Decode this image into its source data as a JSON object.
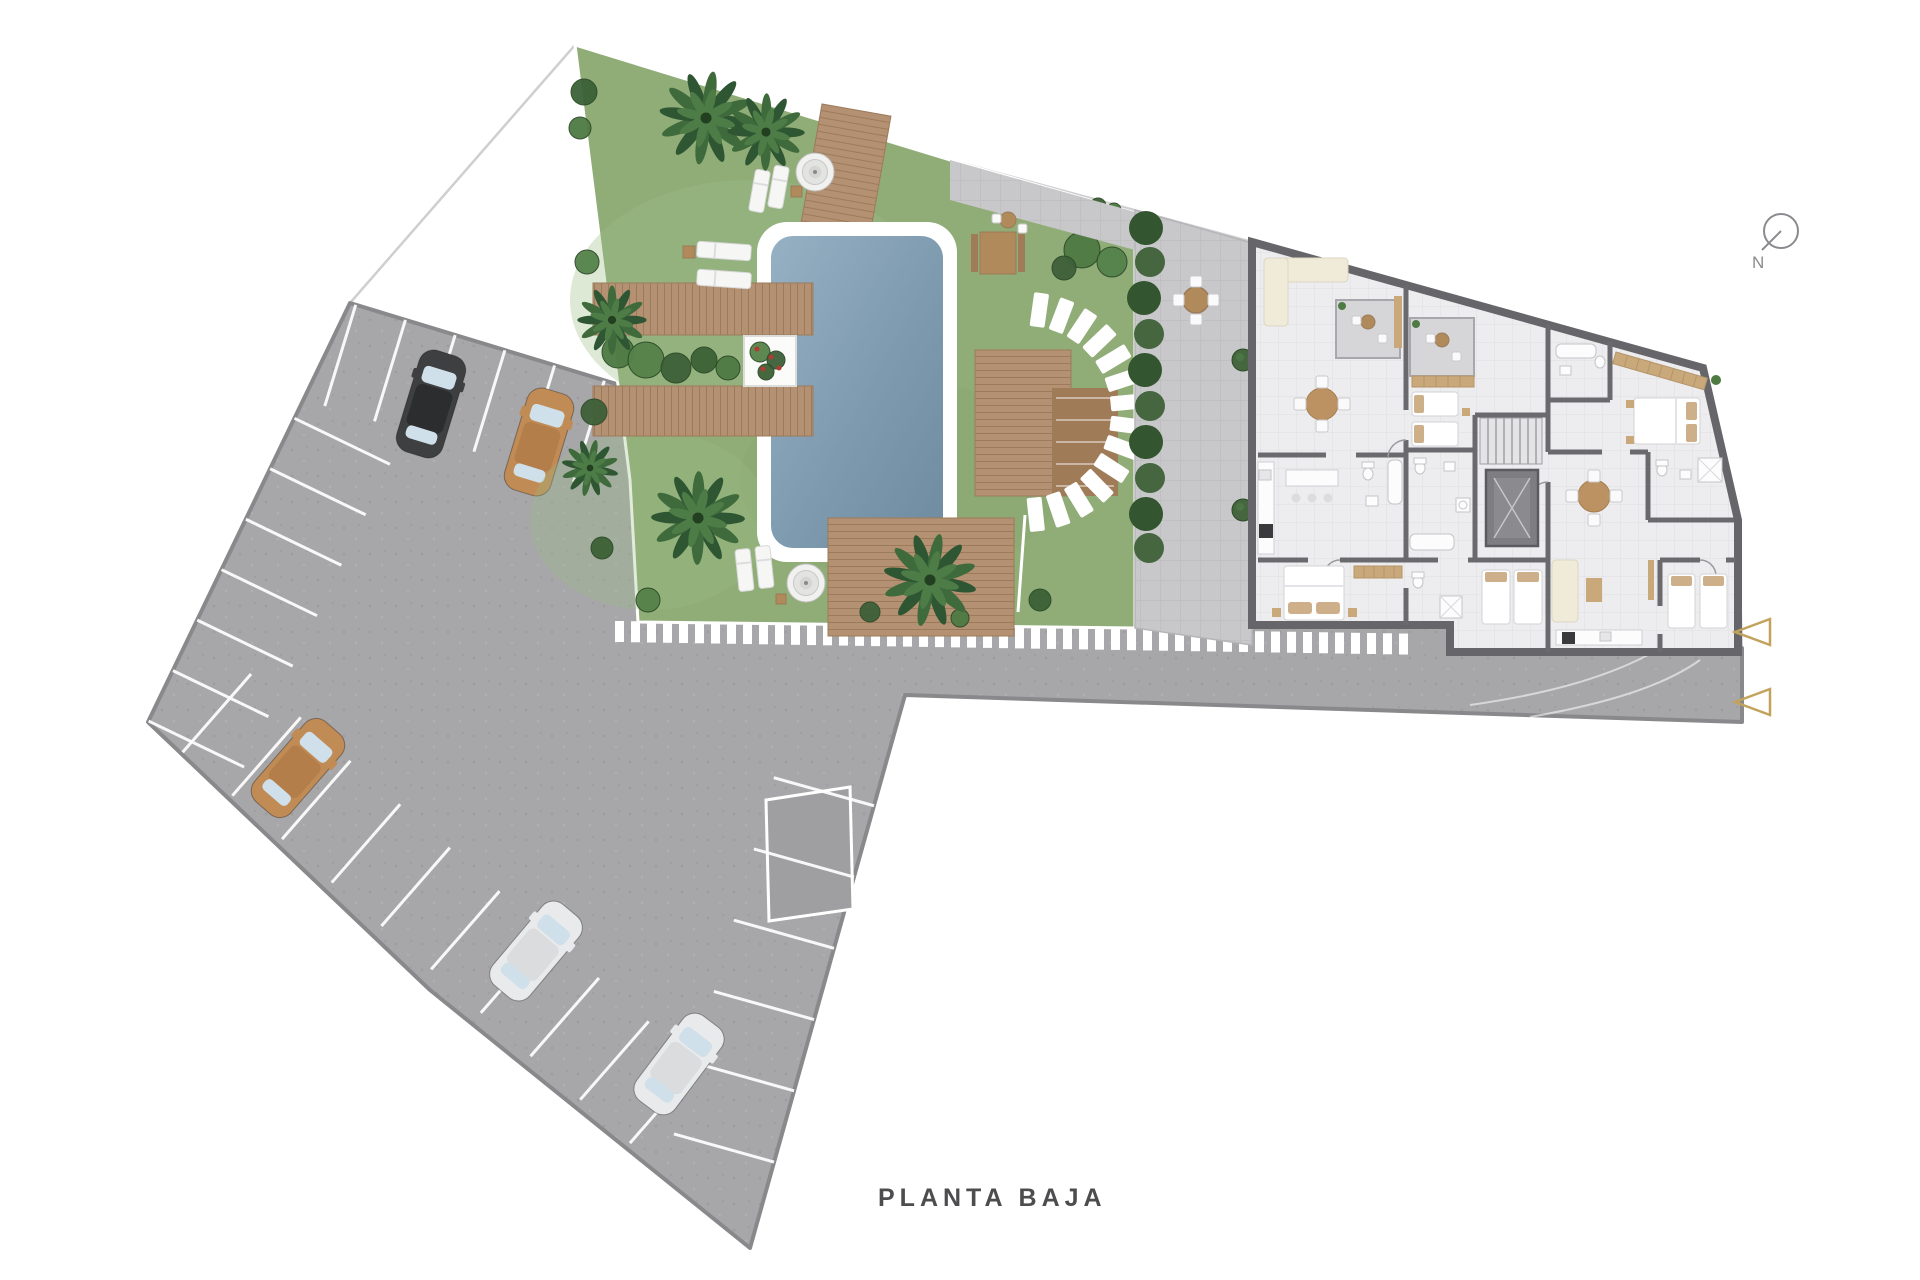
{
  "title": {
    "label": "PLANTA BAJA"
  },
  "compass": {
    "label": "N"
  },
  "palette": {
    "background": "#ffffff",
    "asphalt": "#a7a7a9",
    "asphalt_edge": "#89898c",
    "lawn": "#90ad78",
    "lawn_light": "#9dbd86",
    "lawn_dark": "#87a56f",
    "water_light": "#96b0c4",
    "water_deep": "#6f8ba0",
    "pool_border": "#ffffff",
    "wood": "#b39172",
    "wood_dark": "#9c7b5a",
    "wood_deck2": "#9f7b58",
    "wall": "#6a6a6e",
    "floor": "#ededef",
    "paver": "#c8c8ca",
    "terrace": "#d6d6d8",
    "furniture_wood": "#b08a5a",
    "wardrobe_tan": "#c9a97a",
    "pillow_tan": "#cdb08a",
    "sofa_cream": "#f0ead9",
    "fixture_white": "#fcfcfc",
    "stove_dark": "#3a3a3c",
    "marking_white": "#ffffff",
    "accent_tan": "#c3a35c",
    "text_gray": "#4d4d4f",
    "compass_gray": "#8b8b8f",
    "greens": [
      "#3c6136",
      "#4e7a43",
      "#55824a",
      "#3e6039"
    ],
    "hedge1": "#33552f",
    "hedge2": "#46663f",
    "palm_dark": "#2e5633",
    "palm_mid": "#3f6b3c",
    "palm_light": "#4d7c47",
    "palm_center": "#223f20",
    "flower_red": "#b23b33",
    "car": {
      "black": {
        "body": "#3e3f41",
        "roof": "#2c2d2f"
      },
      "tan": {
        "body": "#c18b55",
        "roof": "#b37e49"
      },
      "white": {
        "body": "#e9eaec",
        "roof": "#dbdcde"
      },
      "window": "#cfe0ea"
    }
  },
  "scene": {
    "cars": [
      {
        "x": 431,
        "y": 404,
        "rot": 17,
        "c": "black"
      },
      {
        "x": 539,
        "y": 442,
        "rot": 17,
        "c": "tan"
      },
      {
        "x": 298,
        "y": 768,
        "rot": 41,
        "c": "tan"
      },
      {
        "x": 536,
        "y": 951,
        "rot": 40,
        "c": "white"
      },
      {
        "x": 679,
        "y": 1064,
        "rot": 37,
        "c": "white"
      }
    ],
    "parking_rows": [
      {
        "bx": 350,
        "by": 303,
        "ux": 0.956,
        "uy": 0.292,
        "px": -0.292,
        "py": 0.956,
        "t0": 6,
        "dt": 52,
        "n": 6,
        "len": 106
      },
      {
        "bx": 350,
        "by": 303,
        "ux": -0.434,
        "uy": 0.901,
        "px": 0.901,
        "py": 0.434,
        "t0": 128,
        "dt": 56,
        "n": 7,
        "len": 106
      },
      {
        "bx": 148,
        "by": 722,
        "ux": 0.753,
        "uy": 0.658,
        "px": 0.658,
        "py": -0.753,
        "t0": 46,
        "dt": 66,
        "n": 10,
        "len": 104
      },
      {
        "bx": 905,
        "by": 695,
        "ux": -0.27,
        "uy": 0.963,
        "px": -0.963,
        "py": -0.27,
        "t0": 115,
        "dt": 74,
        "n": 6,
        "len": 104
      }
    ],
    "walkway_stripes": {
      "x0": 615,
      "x1": 1412,
      "step": 16,
      "w": 9,
      "h": 21,
      "y": 621,
      "slope": 0.016
    },
    "stepping_stones": {
      "cx": 1025,
      "cy": 412,
      "r": 103,
      "a0": -82,
      "a1": 84,
      "n": 14,
      "w": 34,
      "h": 15
    },
    "palms": [
      {
        "x": 706,
        "y": 118,
        "r": 46
      },
      {
        "x": 766,
        "y": 132,
        "r": 38
      },
      {
        "x": 612,
        "y": 320,
        "r": 34
      },
      {
        "x": 590,
        "y": 468,
        "r": 28
      },
      {
        "x": 698,
        "y": 518,
        "r": 46
      },
      {
        "x": 930,
        "y": 580,
        "r": 46
      }
    ],
    "bushes": [
      [
        584,
        92,
        13
      ],
      [
        580,
        128,
        11
      ],
      [
        587,
        262,
        12
      ],
      [
        594,
        412,
        13
      ],
      [
        602,
        548,
        11
      ],
      [
        618,
        352,
        16
      ],
      [
        646,
        360,
        18
      ],
      [
        676,
        368,
        15
      ],
      [
        704,
        360,
        13
      ],
      [
        728,
        368,
        12
      ],
      [
        760,
        352,
        10
      ],
      [
        776,
        360,
        9
      ],
      [
        766,
        372,
        8
      ],
      [
        1082,
        250,
        18
      ],
      [
        1112,
        262,
        15
      ],
      [
        1064,
        268,
        12
      ],
      [
        1098,
        206,
        8
      ],
      [
        1114,
        210,
        7
      ],
      [
        648,
        600,
        12
      ],
      [
        870,
        612,
        10
      ],
      [
        1040,
        600,
        11
      ],
      [
        960,
        618,
        9
      ]
    ],
    "hedge_row": [
      [
        1146,
        228
      ],
      [
        1150,
        262
      ],
      [
        1144,
        298
      ],
      [
        1149,
        334
      ],
      [
        1145,
        370
      ],
      [
        1150,
        406
      ],
      [
        1146,
        442
      ],
      [
        1150,
        478
      ],
      [
        1146,
        514
      ],
      [
        1149,
        548
      ]
    ],
    "loungers": [
      [
        752,
        170,
        15,
        42,
        10
      ],
      [
        771,
        166,
        15,
        42,
        10
      ],
      [
        697,
        243,
        54,
        16,
        4
      ],
      [
        697,
        271,
        54,
        16,
        4
      ],
      [
        737,
        549,
        15,
        42,
        -6
      ],
      [
        757,
        546,
        15,
        42,
        -6
      ]
    ],
    "side_tables": [
      [
        791,
        186,
        11
      ],
      [
        683,
        246,
        12
      ],
      [
        776,
        594,
        10
      ]
    ],
    "parasols": [
      [
        815,
        172,
        19
      ],
      [
        806,
        583,
        19
      ]
    ],
    "flowers": [
      [
        757,
        349
      ],
      [
        771,
        357
      ],
      [
        763,
        369
      ],
      [
        779,
        368
      ]
    ],
    "ball_trees": [
      [
        1243,
        360
      ],
      [
        1243,
        510
      ]
    ],
    "entrance_arrows": [
      [
        1735,
        632
      ],
      [
        1735,
        702
      ]
    ]
  }
}
